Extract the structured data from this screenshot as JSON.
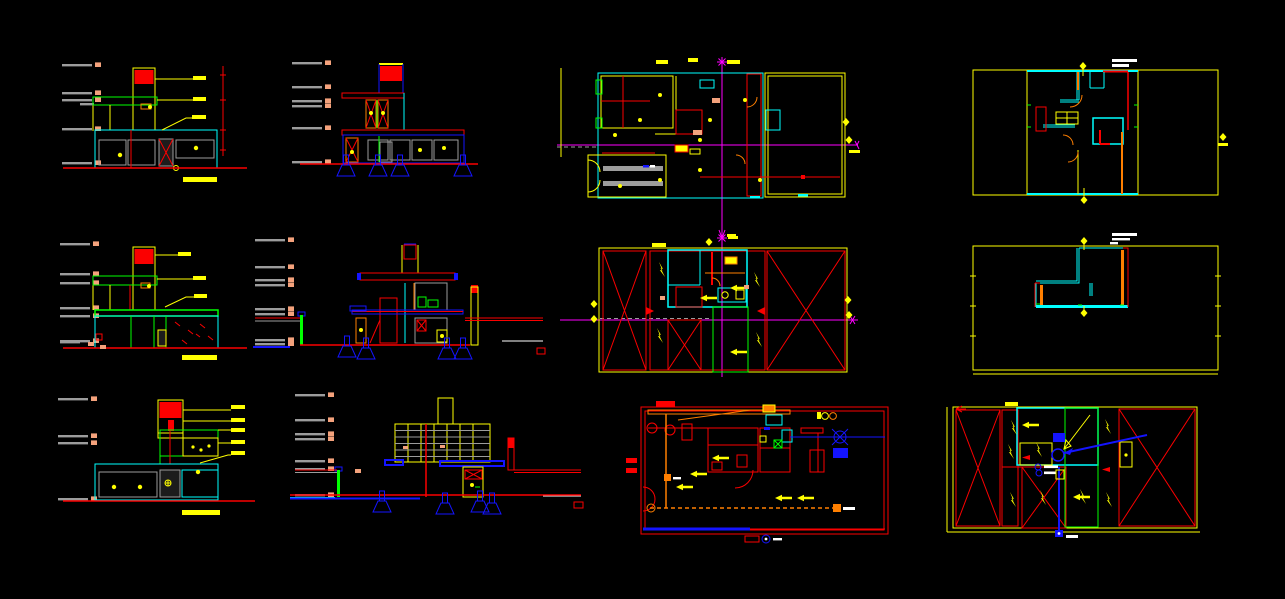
{
  "app": {
    "surface": "cad-model-space",
    "background": "#000000"
  },
  "palette": {
    "bg": "#000000",
    "yellow": "#FFFF00",
    "red": "#FB0000",
    "cyan": "#00FFFF",
    "green": "#00FF00",
    "blue": "#1414FF",
    "magenta": "#FF00FF",
    "orange": "#FF7F00",
    "gray": "#9C9C9C",
    "white": "#FFFFFF",
    "salmon": "#F4A27C"
  },
  "drawings": [
    {
      "id": "elevation-1",
      "kind": "elevation",
      "row": 1,
      "col": 1
    },
    {
      "id": "section-1",
      "kind": "section",
      "row": 1,
      "col": 2
    },
    {
      "id": "ground-floor-plan",
      "kind": "floor-plan",
      "row": 1,
      "col": 3
    },
    {
      "id": "upper-floor-plan",
      "kind": "floor-plan",
      "row": 1,
      "col": 4
    },
    {
      "id": "elevation-2",
      "kind": "elevation",
      "row": 2,
      "col": 1
    },
    {
      "id": "section-2",
      "kind": "section",
      "row": 2,
      "col": 2
    },
    {
      "id": "first-floor-roof-plan",
      "kind": "floor-plan",
      "row": 2,
      "col": 3
    },
    {
      "id": "top-level-plan",
      "kind": "floor-plan",
      "row": 2,
      "col": 4
    },
    {
      "id": "elevation-3",
      "kind": "elevation",
      "row": 3,
      "col": 1
    },
    {
      "id": "section-3",
      "kind": "section",
      "row": 3,
      "col": 2
    },
    {
      "id": "installations-plan",
      "kind": "utility-plan",
      "row": 3,
      "col": 3
    },
    {
      "id": "roof-drainage-plan",
      "kind": "roof-plan",
      "row": 3,
      "col": 4
    }
  ]
}
